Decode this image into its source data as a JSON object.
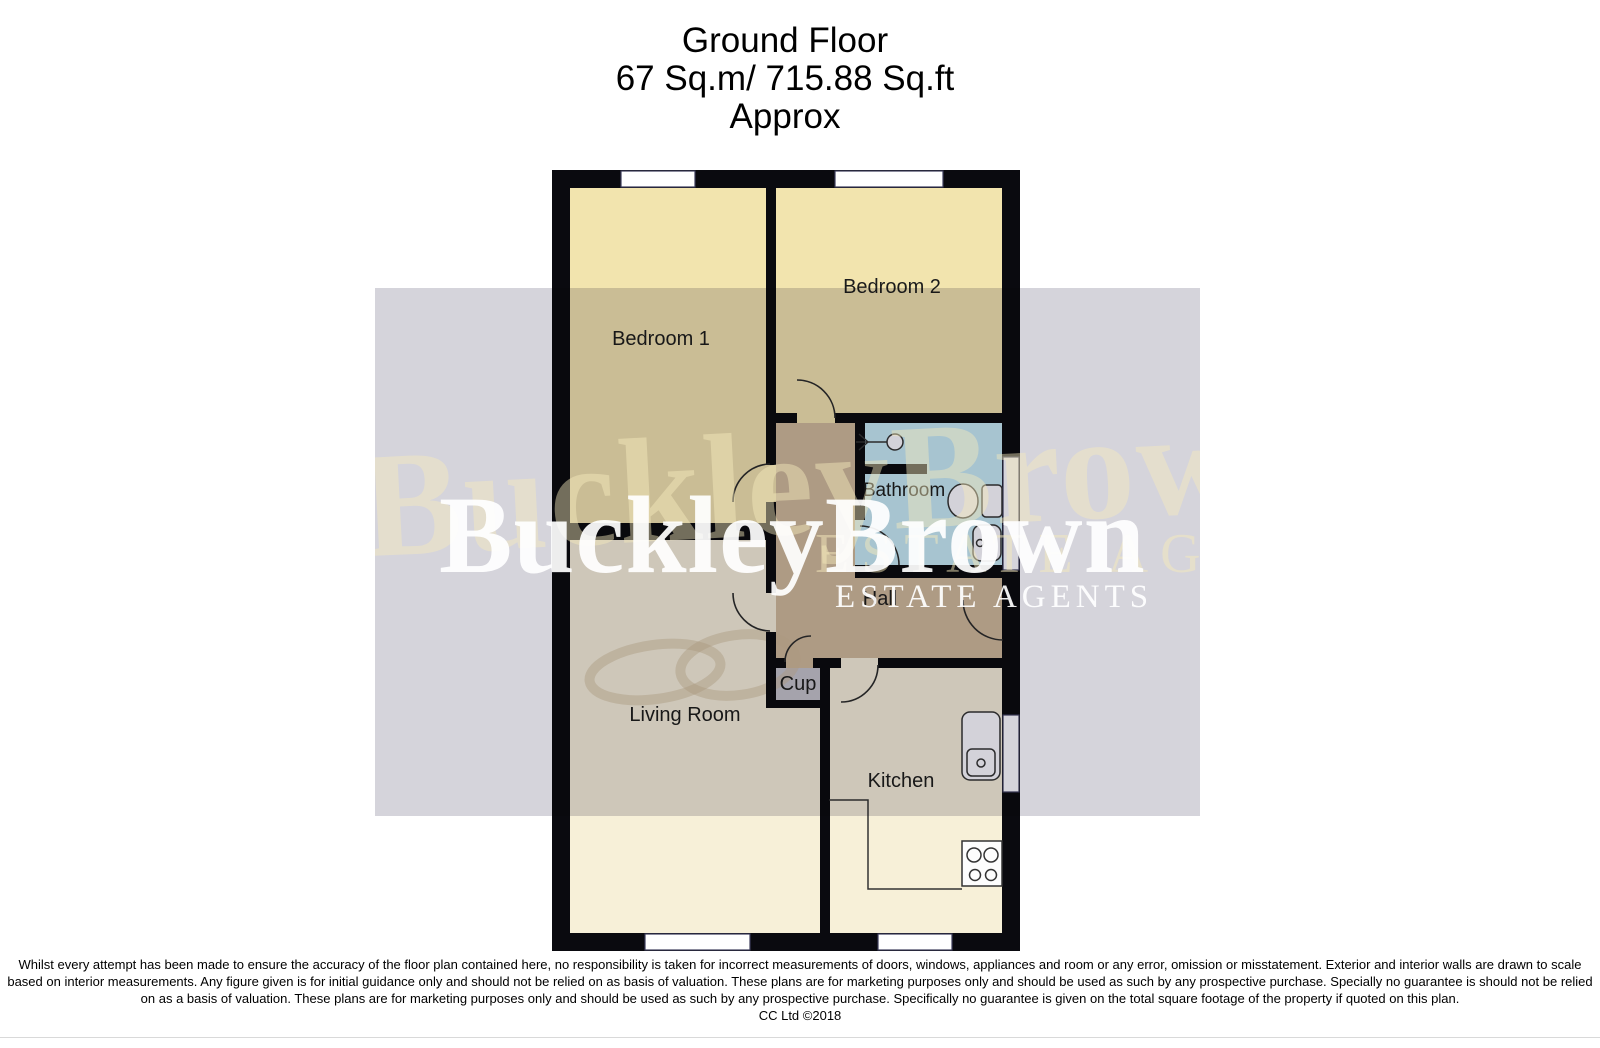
{
  "title": {
    "line1": "Ground Floor",
    "line2": "67 Sq.m/ 715.88 Sq.ft",
    "line3": "Approx"
  },
  "watermark": {
    "brand": "BuckleyBrown",
    "tagline": "ESTATE AGENTS",
    "background_brand": "BuckleyBrown",
    "background_tagline": "ESTATE AGENTS"
  },
  "rooms": {
    "bedroom1": {
      "label": "Bedroom 1"
    },
    "bedroom2": {
      "label": "Bedroom 2"
    },
    "bathroom": {
      "label": "Bathroom"
    },
    "hall": {
      "label": "Hall"
    },
    "cupboard": {
      "label": "Cup"
    },
    "living_room": {
      "label": "Living Room"
    },
    "kitchen": {
      "label": "Kitchen"
    }
  },
  "colors": {
    "bedroom_floor": "#f2e4ae",
    "living_floor": "#f7f0d8",
    "kitchen_floor": "#f7f0d8",
    "hall_floor": "#d1ba9a",
    "bathroom_floor": "#c8ecf2",
    "cupboard_fill": "#c6c4c8",
    "wall": "#0a0a0f",
    "watermark_band": "#d5d4db"
  },
  "disclaimer": {
    "line1": "Whilst every attempt has been made to ensure the accuracy of the floor plan contained here, no responsibility is taken for incorrect measurements of doors, windows, appliances and room or any error, omission or misstatement. Exterior and interior walls are drawn to scale",
    "line2": "based on interior measurements. Any figure given is for initial guidance only and should not be relied on as basis of valuation. These plans are for marketing purposes only and should be used as such by any prospective purchase. Specially no guarantee is should not be relied",
    "line3": "on as a basis of valuation. These plans are for marketing purposes only and should be used as such by any prospective purchase. Specifically no guarantee is given on the total square footage of the property if quoted on this plan.",
    "copyright": "CC Ltd ©2018"
  }
}
